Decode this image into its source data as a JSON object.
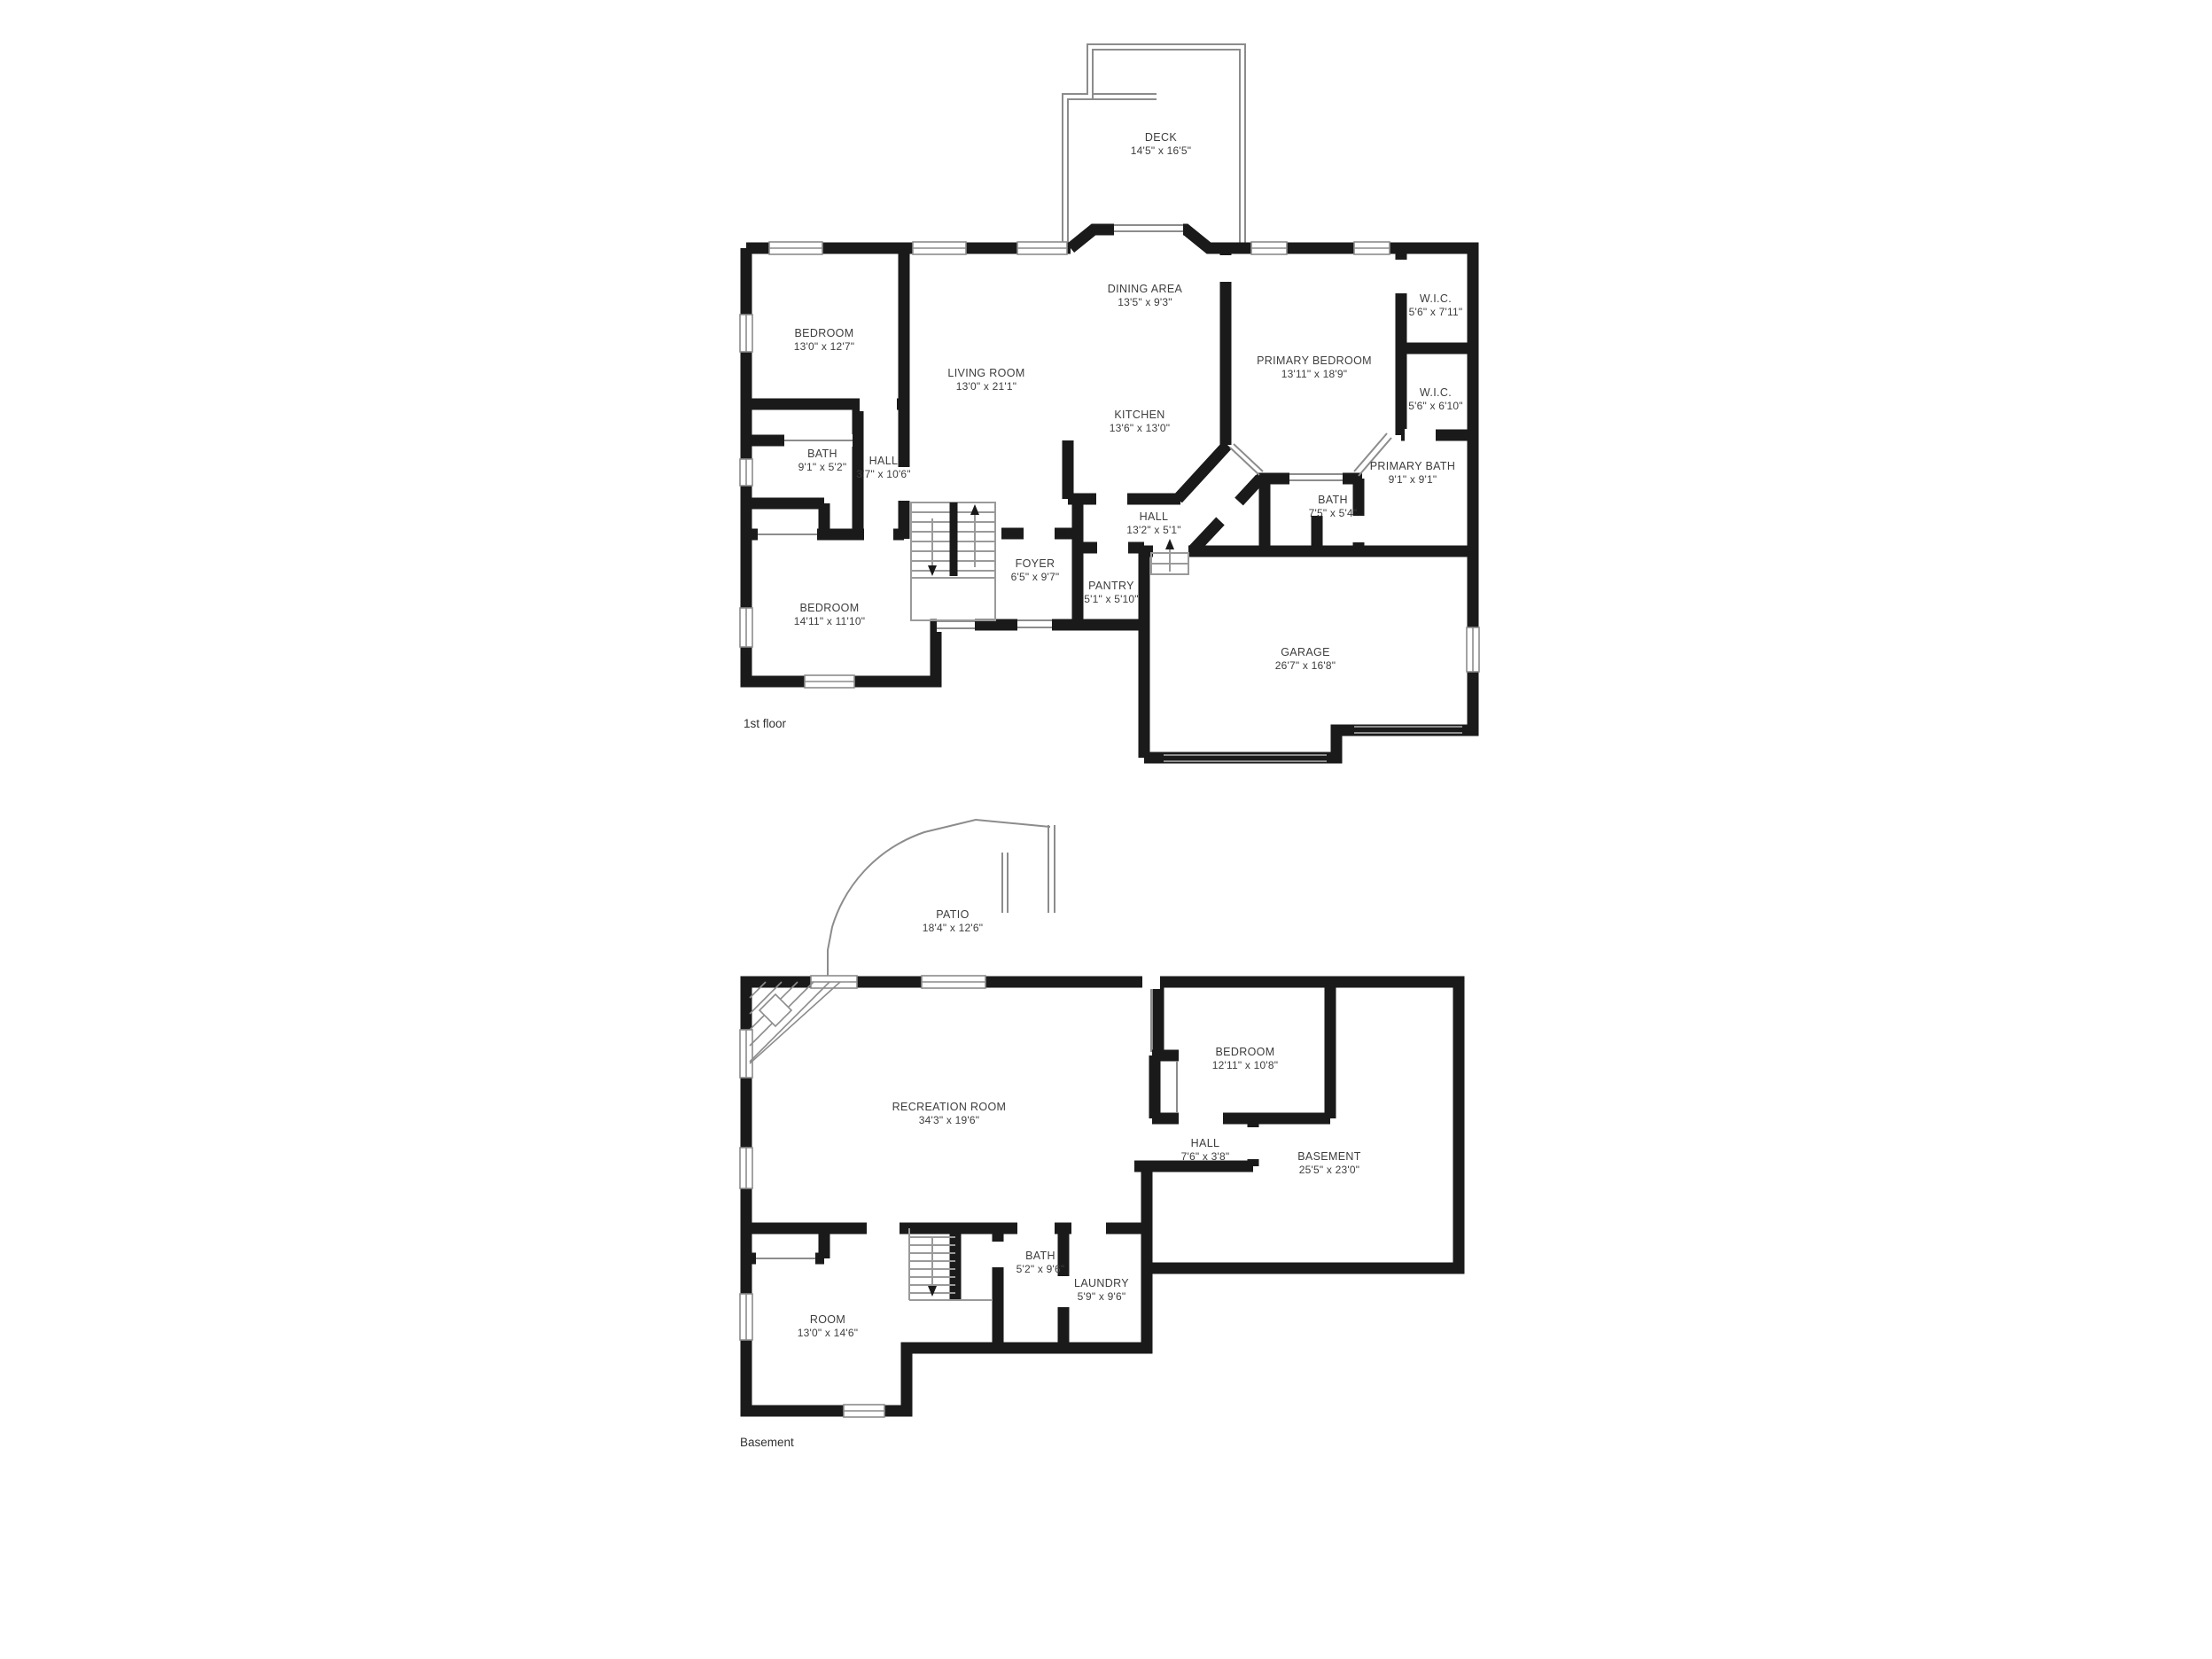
{
  "document": {
    "type": "floor-plan"
  },
  "colors": {
    "wall": "#1a1a1a",
    "thin_line": "#8c8c8c",
    "text": "#3d3d3d",
    "background": "#ffffff"
  },
  "floors": [
    {
      "label": "1st floor",
      "rooms": [
        {
          "name": "DECK",
          "dims": "14'5\" x 16'5\""
        },
        {
          "name": "DINING AREA",
          "dims": "13'5\" x 9'3\""
        },
        {
          "name": "BEDROOM",
          "dims": "13'0\" x 12'7\""
        },
        {
          "name": "LIVING ROOM",
          "dims": "13'0\" x 21'1\""
        },
        {
          "name": "PRIMARY BEDROOM",
          "dims": "13'11\" x 18'9\""
        },
        {
          "name": "W.I.C.",
          "dims": "5'6\" x 7'11\""
        },
        {
          "name": "W.I.C.",
          "dims": "5'6\" x 6'10\""
        },
        {
          "name": "KITCHEN",
          "dims": "13'6\" x 13'0\""
        },
        {
          "name": "BATH",
          "dims": "9'1\" x 5'2\""
        },
        {
          "name": "HALL",
          "dims": "3'7\" x 10'6\""
        },
        {
          "name": "PRIMARY BATH",
          "dims": "9'1\" x 9'1\""
        },
        {
          "name": "BATH",
          "dims": "7'5\" x 5'4\""
        },
        {
          "name": "HALL",
          "dims": "13'2\" x 5'1\""
        },
        {
          "name": "FOYER",
          "dims": "6'5\" x 9'7\""
        },
        {
          "name": "PANTRY",
          "dims": "5'1\" x 5'10\""
        },
        {
          "name": "BEDROOM",
          "dims": "14'11\" x 11'10\""
        },
        {
          "name": "GARAGE",
          "dims": "26'7\" x 16'8\""
        }
      ]
    },
    {
      "label": "Basement",
      "rooms": [
        {
          "name": "PATIO",
          "dims": "18'4\" x 12'6\""
        },
        {
          "name": "RECREATION ROOM",
          "dims": "34'3\" x 19'6\""
        },
        {
          "name": "BEDROOM",
          "dims": "12'11\" x 10'8\""
        },
        {
          "name": "HALL",
          "dims": "7'6\" x 3'8\""
        },
        {
          "name": "BASEMENT",
          "dims": "25'5\" x 23'0\""
        },
        {
          "name": "BATH",
          "dims": "5'2\" x 9'6\""
        },
        {
          "name": "LAUNDRY",
          "dims": "5'9\" x 9'6\""
        },
        {
          "name": "ROOM",
          "dims": "13'0\" x 14'6\""
        }
      ]
    }
  ]
}
